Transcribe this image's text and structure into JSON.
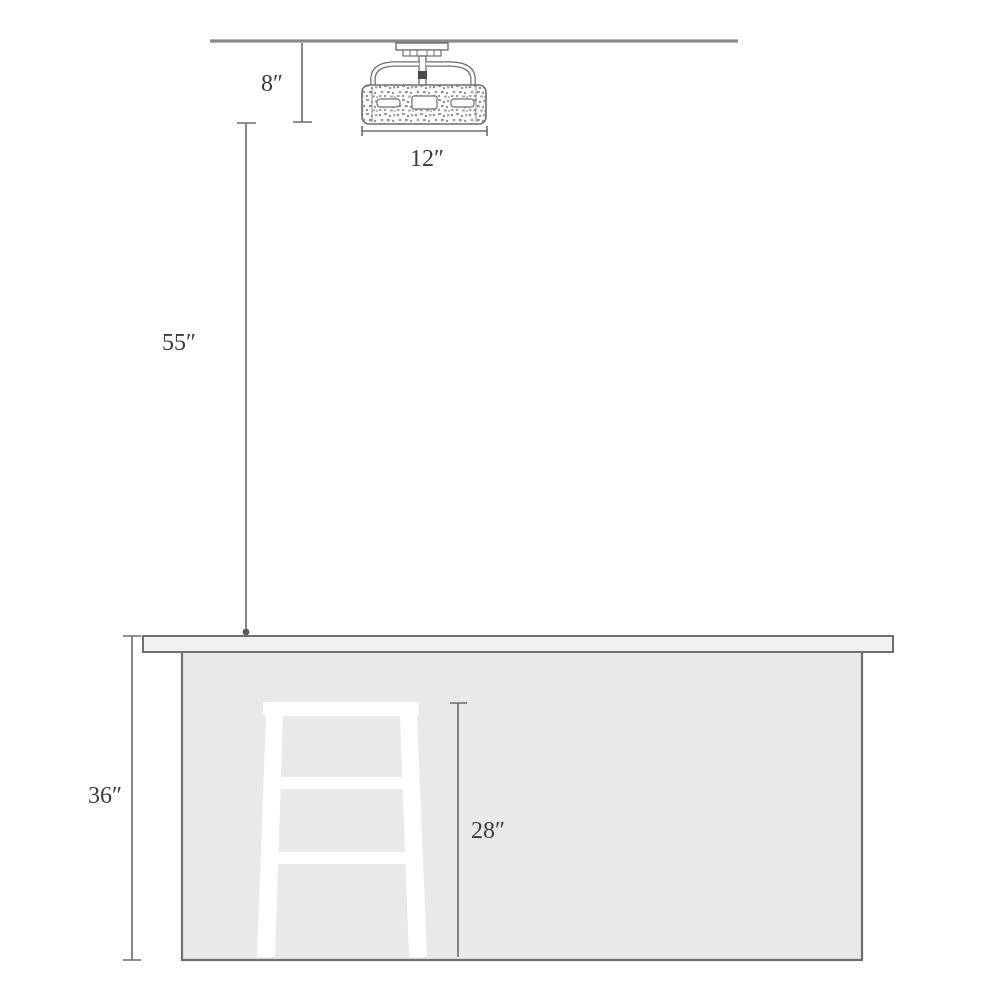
{
  "diagram": {
    "type": "light-fixture-mounting-height-diagram",
    "labels": {
      "ceiling_gap": "8″",
      "fixture_width": "12″",
      "drop_height": "55″",
      "counter_height": "36″",
      "stool_height": "28″"
    },
    "elements": {
      "ceiling": "ceiling-line",
      "fixture": "semi-flush-drum-light",
      "counter": "kitchen-counter",
      "stool": "bar-stool"
    },
    "colors": {
      "background": "#ffffff",
      "ceiling_line": "#8a8a8a",
      "dimension_line": "#6b6b6b",
      "counter_fill": "#e9e9e9",
      "countertop_fill": "#f1f1f1",
      "counter_border": "#6f6f6f",
      "stool_fill": "#ffffff",
      "text": "#3b3b3b"
    }
  }
}
